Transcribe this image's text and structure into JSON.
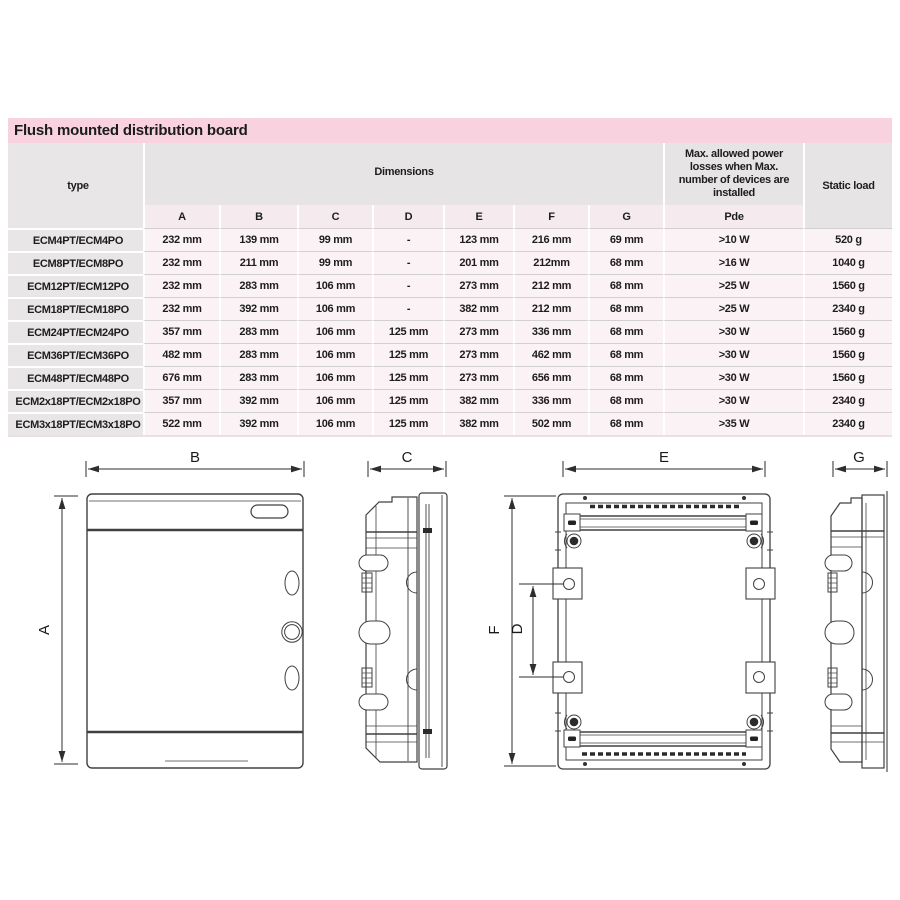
{
  "title_bar": {
    "label": "Flush mounted distribution board"
  },
  "table": {
    "header": {
      "type": "type",
      "dimensions": "Dimensions",
      "dim_columns": [
        "A",
        "B",
        "C",
        "D",
        "E",
        "F",
        "G"
      ],
      "power": "Max. allowed power losses when Max. number of devices are installed",
      "power_sub": "Pde",
      "static_load": "Static load"
    },
    "rows": [
      {
        "type": "ECM4PT/ECM4PO",
        "a": "232 mm",
        "b": "139 mm",
        "c": "99 mm",
        "d": "-",
        "e": "123 mm",
        "f": "216 mm",
        "g": "69 mm",
        "pde": ">10 W",
        "load": "520 g"
      },
      {
        "type": "ECM8PT/ECM8PO",
        "a": "232 mm",
        "b": "211 mm",
        "c": "99 mm",
        "d": "-",
        "e": "201 mm",
        "f": "212mm",
        "g": "68 mm",
        "pde": ">16 W",
        "load": "1040 g"
      },
      {
        "type": "ECM12PT/ECM12PO",
        "a": "232 mm",
        "b": "283 mm",
        "c": "106 mm",
        "d": "-",
        "e": "273 mm",
        "f": "212 mm",
        "g": "68 mm",
        "pde": ">25 W",
        "load": "1560 g"
      },
      {
        "type": "ECM18PT/ECM18PO",
        "a": "232 mm",
        "b": "392 mm",
        "c": "106 mm",
        "d": "-",
        "e": "382 mm",
        "f": "212 mm",
        "g": "68 mm",
        "pde": ">25 W",
        "load": "2340 g"
      },
      {
        "type": "ECM24PT/ECM24PO",
        "a": "357 mm",
        "b": "283 mm",
        "c": "106 mm",
        "d": "125 mm",
        "e": "273 mm",
        "f": "336 mm",
        "g": "68 mm",
        "pde": ">30 W",
        "load": "1560 g"
      },
      {
        "type": "ECM36PT/ECM36PO",
        "a": "482 mm",
        "b": "283 mm",
        "c": "106 mm",
        "d": "125 mm",
        "e": "273 mm",
        "f": "462 mm",
        "g": "68 mm",
        "pde": ">30 W",
        "load": "1560 g"
      },
      {
        "type": "ECM48PT/ECM48PO",
        "a": "676 mm",
        "b": "283 mm",
        "c": "106 mm",
        "d": "125 mm",
        "e": "273 mm",
        "f": "656 mm",
        "g": "68 mm",
        "pde": ">30 W",
        "load": "1560 g"
      },
      {
        "type": "ECM2x18PT/ECM2x18PO",
        "a": "357 mm",
        "b": "392 mm",
        "c": "106 mm",
        "d": "125 mm",
        "e": "382 mm",
        "f": "336 mm",
        "g": "68 mm",
        "pde": ">30 W",
        "load": "2340 g"
      },
      {
        "type": "ECM3x18PT/ECM3x18PO",
        "a": "522 mm",
        "b": "392 mm",
        "c": "106 mm",
        "d": "125 mm",
        "e": "382 mm",
        "f": "502 mm",
        "g": "68 mm",
        "pde": ">35 W",
        "load": "2340 g"
      }
    ]
  },
  "drawings": {
    "front_view": {
      "width_label": "B",
      "height_label": "A"
    },
    "side_view": {
      "depth_label": "C"
    },
    "back_view": {
      "width_label": "E",
      "height_label": "F",
      "hole_spacing_label": "D"
    },
    "recessed_side_view": {
      "depth_label": "G"
    }
  },
  "colors": {
    "title_bar_bg": "#f8d2de",
    "header_bg": "#e7e4e6",
    "subheader_bg": "#f5ebef",
    "type_column_bg": "#e9e6e8",
    "cell_bg": "#fbf2f5",
    "row_divider": "#d2cfd1",
    "text": "#1d1d1d",
    "drawing_line": "#404040"
  }
}
